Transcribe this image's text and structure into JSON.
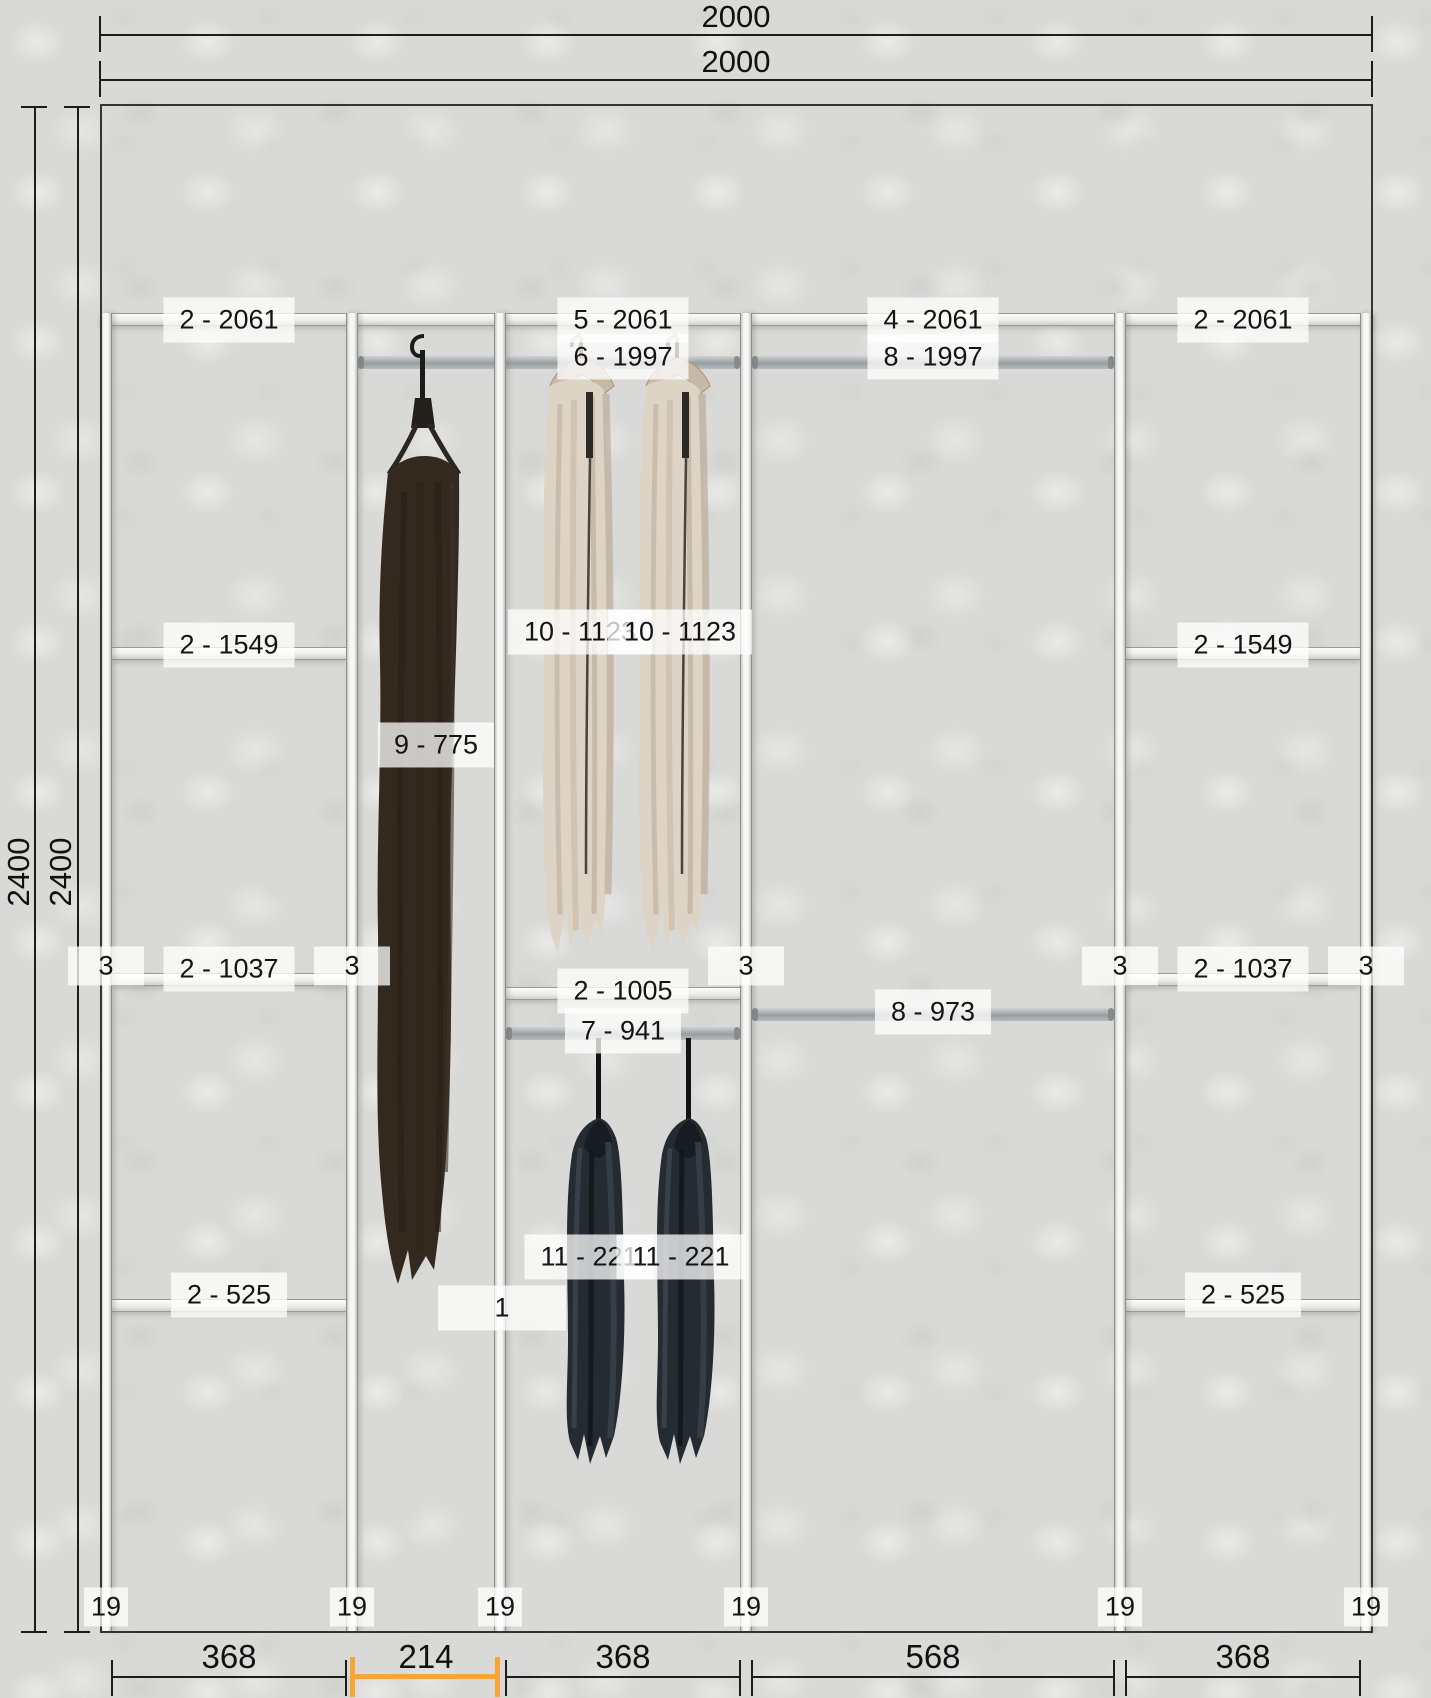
{
  "canvas": {
    "type": "wardrobe elevation drawing",
    "width_px": 1431,
    "height_px": 1698
  },
  "dimensions": {
    "top": [
      "2000",
      "2000"
    ],
    "left": [
      "2400",
      "2400"
    ],
    "bottom": [
      "368",
      "214",
      "368",
      "568",
      "368"
    ],
    "highlighted_bottom_index": 1
  },
  "labels": {
    "sec1_shelf_top": "2 - 2061",
    "sec1_shelf_2": "2 - 1549",
    "sec1_shelf_3": "2 - 1037",
    "sec1_shelf_4": "2 - 525",
    "sec3_shelf_top": "5 - 2061",
    "sec3_rod_top": "6 - 1997",
    "sec3_shelf_mid": "2 - 1005",
    "sec3_rod_mid": "7 - 941",
    "sec4_shelf_top": "4 - 2061",
    "sec4_rod_top": "8 - 1997",
    "sec4_rod_mid": "8 - 973",
    "sec5_shelf_top": "2 - 2061",
    "sec5_shelf_2": "2 - 1549",
    "sec5_shelf_3": "2 - 1037",
    "sec5_shelf_4": "2 - 525",
    "dress": "9 - 775",
    "shirt_1": "10 - 1123",
    "shirt_2": "10 - 1123",
    "jacket_1": "11 - 221",
    "jacket_2": "11 - 221",
    "panel_mid_number": "1",
    "panel_edge_thickness": "3",
    "panel_base_thickness": "19"
  },
  "colors": {
    "wall": "#d9d9d7",
    "panel": "#f5f5f3",
    "rod": "#9aa0a2",
    "dimension_line": "#1c1c1c",
    "dimension_highlight": "#f5a53a",
    "label_background": "#ffffff",
    "dress": "#33291f",
    "shirt": "#ded4c6",
    "jacket": "#242b31"
  }
}
